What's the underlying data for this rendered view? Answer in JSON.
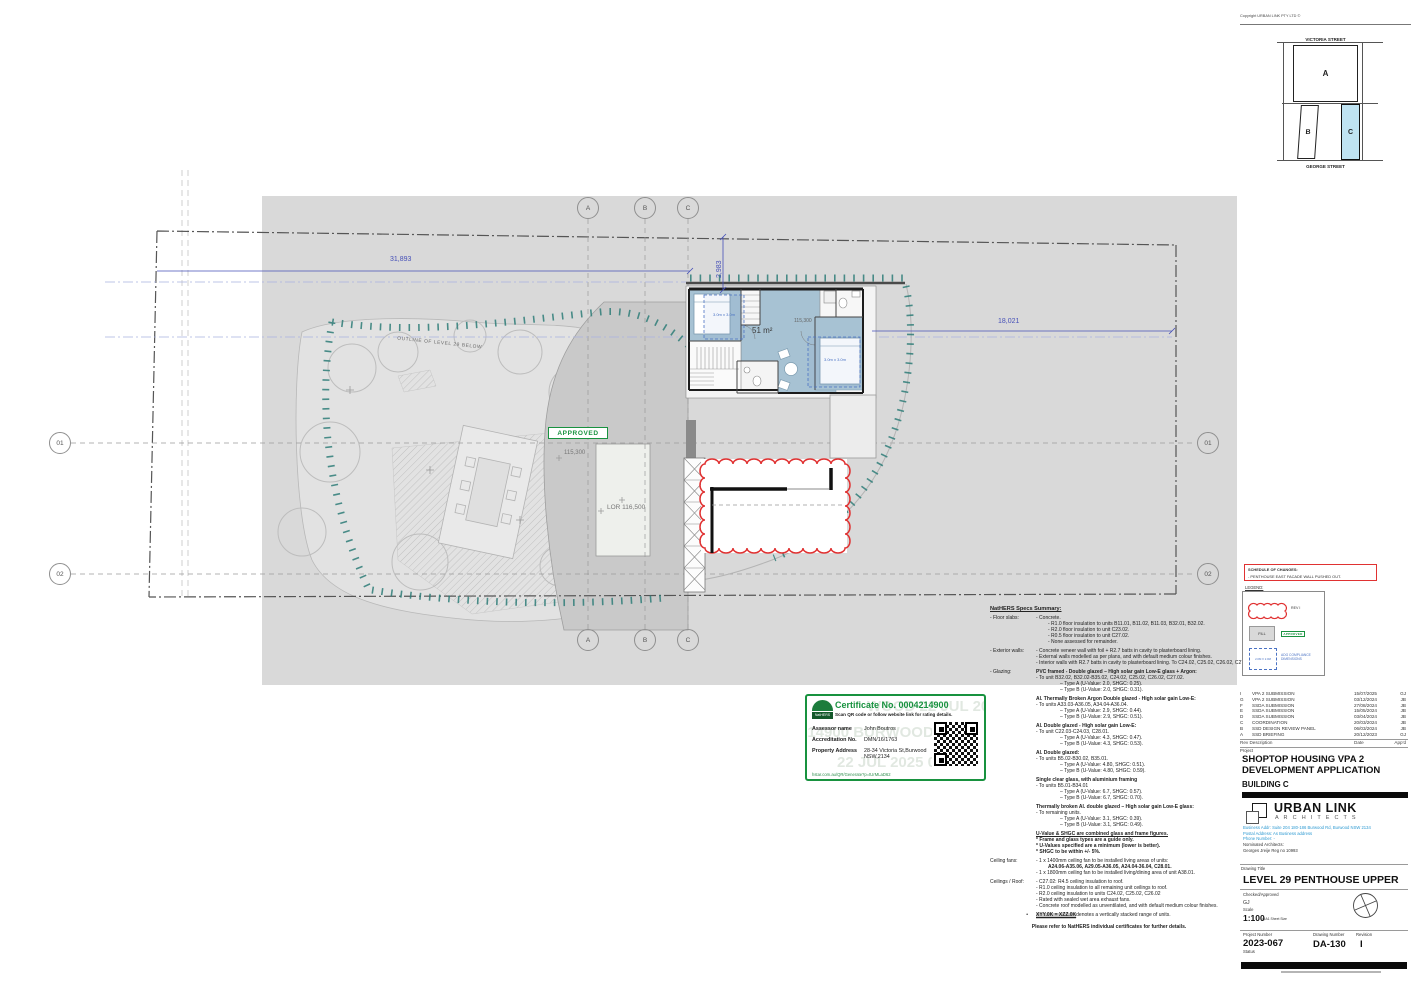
{
  "colors": {
    "accent_blue": "#4650b8",
    "survey_teal": "#2e7d78",
    "approved_green": "#18923f",
    "revision_red": "#e03232",
    "room_blue": "#a7c2d3",
    "keyplan_highlight": "#bfe3f2"
  },
  "keyplan": {
    "copyright": "Copyright URBAN LINK PTY LTD ©",
    "street_top": "VICTORIA STREET",
    "street_bottom": "GEORGE STREET",
    "block_a": "A",
    "block_b": "B",
    "block_c": "C"
  },
  "plan": {
    "outline_label": "OUTLINE OF LEVEL 29 BELOW",
    "approved_stamp": "APPROVED",
    "terrace_level": "115,300",
    "lor_level": "LOR 116,500",
    "unit_area": "51 m²",
    "unit_level": "115,300",
    "adg_left": "3.0m x 3.0m",
    "adg_right": "3.0m x 3.0m",
    "dim_top": "31,893",
    "dim_offset": "2,983",
    "dim_right": "18,021",
    "grid_cols": {
      "a": "A",
      "b": "B",
      "c": "C"
    },
    "grid_rows": {
      "r1": "01",
      "r2": "02"
    }
  },
  "certificate": {
    "number": "Certificate No. 0004214900",
    "subtitle": "Scan QR code or follow website link for rating details.",
    "assessor_label": "Assessor name",
    "assessor": "John Boutros",
    "accreditation_label": "Accreditation No.",
    "accreditation": "DMN/16/1763",
    "property_label": "Property Address",
    "property": "28-34 Victoria St,Burwood NSW,2134",
    "link": "hstar.com.au/QR/Generate?p=tUrMLaD62",
    "logo_text": "NatHERS",
    "watermark_1": "WOOD 22 JUL 2025",
    "watermark_2": "214900 BURWOOD",
    "watermark_3": "22 JUL 2025 00"
  },
  "specs": {
    "title": "NatHERS Specs Summary:",
    "lines": [
      {
        "l": "- Floor slabs:",
        "t": "- Concrete.",
        "c": ""
      },
      {
        "t": "- R1.0 floor insulation to units B11.01, B11.02, B11.03, B32.01, B32.02.",
        "c": "i1"
      },
      {
        "t": "- R2.0 floor insulation to unit C23.02.",
        "c": "i1"
      },
      {
        "t": "- R0.5 floor insulation to unit C27.02.",
        "c": "i1"
      },
      {
        "t": "- None assessed for remainder.",
        "c": "i1"
      },
      {
        "c": "sp"
      },
      {
        "l": "- Exterior walls:",
        "t": "- Concrete veneer wall with foil + R2.7 batts in cavity to plasterboard lining.",
        "c": ""
      },
      {
        "t": "- External walls modelled as per plans, and with default medium colour finishes.",
        "c": ""
      },
      {
        "t": "- Interior walls with R2.7 batts in cavity to plasterboard lining. To C24.02, C25.02, C26.02, C27.02.",
        "c": ""
      },
      {
        "c": "sp"
      },
      {
        "l": "- Glazing:",
        "t": "PVC framed - Double glazed – High solar gain Low-E glass + Argon:",
        "c": "b"
      },
      {
        "t": "- To unit B32.02, B32.02-B35.02, C24.02, C25.02, C26.02, C27.02.",
        "c": ""
      },
      {
        "t": "– Type A (U-Value: 2.0, SHGC: 0.25).",
        "c": "i2"
      },
      {
        "t": "– Type B (U-Value: 2.0, SHGC: 0.31).",
        "c": "i2"
      },
      {
        "c": "sp"
      },
      {
        "t": "Al. Thermally Broken Argon Double glazed - High solar gain Low-E:",
        "c": "b"
      },
      {
        "t": "- To units A33.03-A36.05, A34.04-A36.04.",
        "c": ""
      },
      {
        "t": "– Type A (U-Value: 2.9, SHGC: 0.44).",
        "c": "i2"
      },
      {
        "t": "– Type B (U-Value: 2.9, SHGC: 0.51).",
        "c": "i2"
      },
      {
        "c": "sp"
      },
      {
        "t": "Al. Double glazed - High solar gain Low-E:",
        "c": "b"
      },
      {
        "t": "- To unit C22.03-C24.03, C28.01.",
        "c": ""
      },
      {
        "t": "– Type A (U-Value: 4.3, SHGC: 0.47).",
        "c": "i2"
      },
      {
        "t": "– Type B (U-Value: 4.3, SHGC: 0.53).",
        "c": "i2"
      },
      {
        "c": "sp"
      },
      {
        "t": "Al. Double glazed:",
        "c": "b"
      },
      {
        "t": "- To units B5.02-B30.02, B35.01.",
        "c": ""
      },
      {
        "t": "– Type A (U-Value: 4.80, SHGC: 0.51).",
        "c": "i2"
      },
      {
        "t": "– Type B (U-Value: 4.80, SHGC: 0.59).",
        "c": "i2"
      },
      {
        "c": "sp"
      },
      {
        "t": "Single clear glass, with aluminium framing",
        "c": "b"
      },
      {
        "t": "- To units B5.01-B34.01",
        "c": ""
      },
      {
        "t": "– Type A (U-Value: 6.7, SHGC: 0.57).",
        "c": "i2"
      },
      {
        "t": "– Type B (U-Value: 6.7, SHGC: 0.70).",
        "c": "i2"
      },
      {
        "c": "sp"
      },
      {
        "t": "Thermally broken Al. double glazed – High solar gain Low-E glass:",
        "c": "b"
      },
      {
        "t": "- To remaining units.",
        "c": ""
      },
      {
        "t": "– Type A (U-Value: 3.1, SHGC: 0.39).",
        "c": "i2"
      },
      {
        "t": "– Type B (U-Value: 3.1, SHGC: 0.49).",
        "c": "i2"
      },
      {
        "c": "sp"
      },
      {
        "t": "U-Value & SHGC are combined glass and frame figures.",
        "c": "bu"
      },
      {
        "t": "* Frame and glass types are a guide only.",
        "c": "b"
      },
      {
        "t": "* U-Values specified are a minimum (lower is better).",
        "c": "b"
      },
      {
        "t": "* SHGC to be within +/- 5%.",
        "c": "b"
      },
      {
        "c": "sp"
      },
      {
        "l": "Ceiling fans:",
        "t": "- 1 x 1400mm ceiling fan to be installed living areas of units:",
        "c": ""
      },
      {
        "t": "A24.06-A35.06, A29.05-A36.05, A24.04-36.04, C28.01.",
        "c": "b i1"
      },
      {
        "t": "- 1 x 1800mm ceiling fan to be installed living/dining area of unit A38.01.",
        "c": ""
      },
      {
        "c": "sp"
      },
      {
        "l": "Ceilings / Roof:",
        "t": "- C27.02: R4.5 ceiling insulation to roof.",
        "c": ""
      },
      {
        "t": "- R1.0 ceiling insulation to all remaining unit ceilings to roof.",
        "c": ""
      },
      {
        "t": "- R2.0 ceiling insulation to units C24.02, C25.02, C26.02",
        "c": ""
      },
      {
        "t": "- Rated with sealed wet area exhaust fans.",
        "c": ""
      },
      {
        "t": "- Concrete roof modelled as unventilated, and with default medium colour finishes.",
        "c": ""
      },
      {
        "c": "sp"
      },
      {
        "l": "•",
        "hl": "XYY.0K = XZZ.0K",
        "t": " denotes a vertically stacked range of units.",
        "c": "hlb"
      }
    ],
    "footer": "Please refer to NatHERS individual certificates for further details."
  },
  "schedule": {
    "title": "SCHEDULE OF CHANGES:",
    "item": "- PENTHOUSE EAST FACADE WALL PUSHED OUT."
  },
  "legend": {
    "title": "LEGEND:",
    "rev_label": "REV I",
    "fill_label": "FILL",
    "approved_label": "APPROVED",
    "adg_box": "2.0M X 2.0M",
    "adg_label": "ADG COMPLIANCE DIMENSIONS"
  },
  "titleblock": {
    "revisions": [
      {
        "rev": "I",
        "desc": "VPA 2 SUBMISSION",
        "date": "15/07/2025",
        "appd": "GJ"
      },
      {
        "rev": "G",
        "desc": "VPA 2 SUBMISSION",
        "date": "03/12/2024",
        "appd": "JB"
      },
      {
        "rev": "F",
        "desc": "SSDA SUBMISSION",
        "date": "27/08/2024",
        "appd": "JB"
      },
      {
        "rev": "E",
        "desc": "SSDA SUBMISSION",
        "date": "15/05/2024",
        "appd": "JB"
      },
      {
        "rev": "D",
        "desc": "SSDA SUBMISSION",
        "date": "03/04/2024",
        "appd": "JB"
      },
      {
        "rev": "C",
        "desc": "COORDINATION",
        "date": "20/03/2024",
        "appd": "JB"
      },
      {
        "rev": "B",
        "desc": "SSD DESIGN REVIEW PANEL",
        "date": "06/03/2024",
        "appd": "JB"
      },
      {
        "rev": "A",
        "desc": "SSD BRIEFING",
        "date": "20/12/2023",
        "appd": "GJ"
      }
    ],
    "rev_header_left": "Rev Description",
    "rev_header_date": "Date",
    "rev_header_appd": "App'd",
    "project_label": "Project",
    "project_title_1": "SHOPTOP HOUSING VPA 2",
    "project_title_2": "DEVELOPMENT APPLICATION",
    "building": "BUILDING C",
    "firm_name": "URBAN LINK",
    "firm_sub": "A R C H I T E C T S",
    "address_1": "Business Addr: Suite 204 180-186 Burwood Rd, Burwood NSW 2134",
    "address_2": "Postal Address: As Business address",
    "address_3": "Phone Number: -",
    "nominated_label": "Nominated Architects:",
    "nominated_name": "Georges Jreije Reg no 10993",
    "drawing_title_label": "Drawing Title",
    "drawing_title": "LEVEL 29 PENTHOUSE UPPER",
    "checked_label": "Checked/Approved",
    "checked_value": "GJ",
    "scale_label": "Scale",
    "scale_value": "1:100",
    "scale_note": "@A1 Sheet Size",
    "project_number_label": "Project Number",
    "project_number": "2023-067",
    "drawing_number_label": "Drawing Number",
    "drawing_number": "DA-130",
    "revision_label": "Revision",
    "revision_value": "I",
    "status_label": "Status"
  }
}
